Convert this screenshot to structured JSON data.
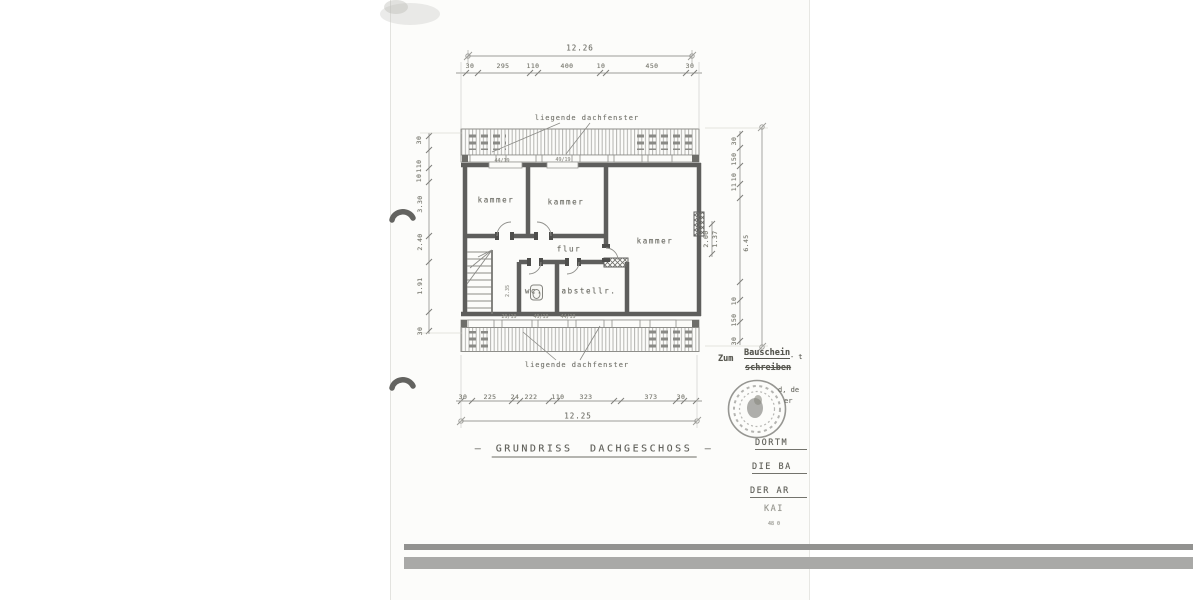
{
  "document": {
    "title": "GRUNDRISS DACHGESCHOSS",
    "title_dash_left": "—",
    "title_dash_right": "—"
  },
  "rooms": {
    "kammer_left": "kammer",
    "kammer_mid": "kammer",
    "kammer_right": "kammer",
    "flur": "flur",
    "wc": "wc.",
    "abstell": "abstellr."
  },
  "skylights": {
    "top_label": "liegende dachfenster",
    "bottom_label": "liegende dachfenster"
  },
  "dimensions": {
    "top": {
      "overall": "12.26",
      "segments": [
        "30",
        "295",
        "110",
        "400",
        "10",
        "450",
        "30"
      ]
    },
    "bottom": {
      "overall": "12.25",
      "segments": [
        "30",
        "225",
        "24",
        "222",
        "110",
        "323",
        "373",
        "30"
      ]
    },
    "left": {
      "segments": [
        "30",
        "110",
        "10",
        "3.30",
        "2.40",
        "1.91",
        "30"
      ]
    },
    "right": {
      "segments_top": [
        "30",
        "150",
        "10",
        "11"
      ],
      "overall": "6.45",
      "segments_bottom": [
        "10",
        "150",
        "30"
      ],
      "inner": [
        "2.00",
        "1.37"
      ]
    },
    "wc_height": "2.35",
    "window_notes_top": [
      "44/19",
      "49/19"
    ],
    "window_notes_bottom": [
      "29/19",
      "49/19",
      "44/19"
    ]
  },
  "stamp": {
    "zum": "Zum",
    "bauschein": "Bauschein",
    "schreiben": "schreiben",
    "dash_note": "- t",
    "partial_1": "d, de",
    "partial_2": "er"
  },
  "side_text": {
    "line1": "DORTM",
    "line2": "DIE BA",
    "line3": "DER AR",
    "line4": "KAI",
    "line5": "48 0"
  },
  "colors": {
    "paper": "#fcfcfa",
    "wall_ink": "#5e5e5c",
    "dim_ink": "#9c9c98",
    "scan_bar": "#a9a9a7"
  }
}
